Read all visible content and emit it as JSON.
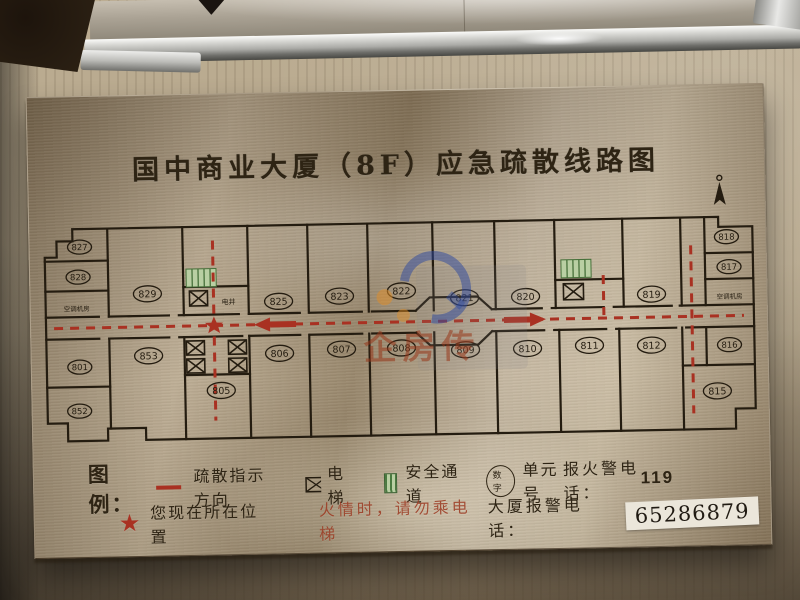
{
  "colors": {
    "accent_red": "#a93122",
    "safe_green": "#b9cfa3",
    "plan_line": "#241c10",
    "plaque_brass": "#a8967a",
    "wall_beige": "#b3a489"
  },
  "plaque": {
    "title": "国中商业大厦（8F）应急疏散线路图"
  },
  "floor_plan": {
    "rooms": {
      "r827": "827",
      "r828": "828",
      "r829": "829",
      "r825": "825",
      "r823": "823",
      "r822": "822",
      "r821": "821",
      "r820": "820",
      "r819": "819",
      "r818": "818",
      "r817": "817",
      "r801": "801",
      "r852": "852",
      "r853": "853",
      "r805": "805",
      "r806": "806",
      "r807": "807",
      "r808": "808",
      "r809": "809",
      "r810": "810",
      "r811": "811",
      "r812": "812",
      "r816": "816",
      "r815": "815"
    },
    "labels": {
      "ac_left": "空调机房",
      "ac_right": "空调机房",
      "shaft": "电井"
    }
  },
  "legend": {
    "heading": "图例：",
    "evac_direction": "疏散指示方向",
    "elevator": "电梯",
    "safe_passage": "安全通道",
    "unit_badge": "数字",
    "unit_label": "单元号",
    "fire_phone_label": "报火警电话：",
    "fire_phone_number": "119",
    "location_star": "★",
    "location_label": "您现在所在位置",
    "fire_warning": "火情时，请勿乘电梯",
    "building_phone_label": "大厦报警电话：",
    "building_phone_number": "65286879"
  },
  "watermark": {
    "text": "企房传"
  }
}
